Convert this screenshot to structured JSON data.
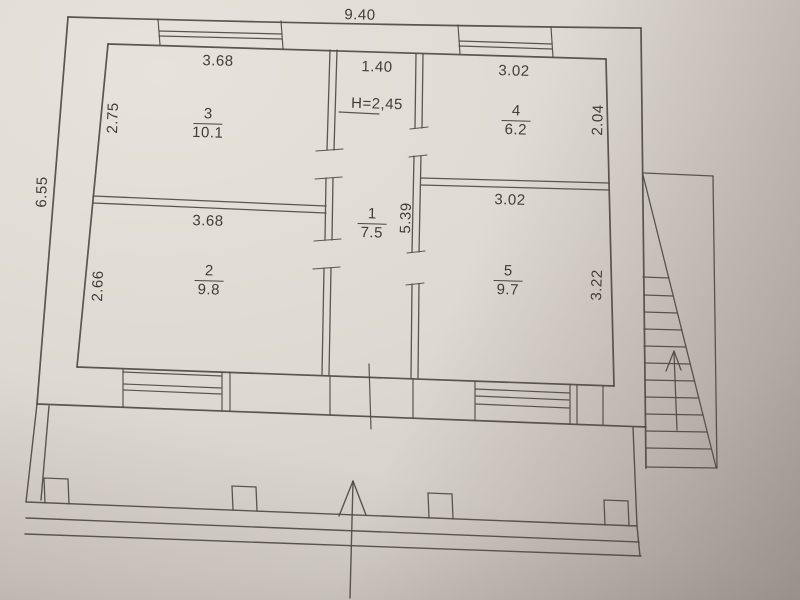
{
  "plan": {
    "overall": {
      "width": "9.40",
      "height": "6.55"
    },
    "ceiling_height": "H=2,45",
    "rooms": [
      {
        "number": "1",
        "area": "7.5",
        "width": "1.40",
        "height": "5.39"
      },
      {
        "number": "2",
        "area": "9.8",
        "width": "3.68",
        "height": "2.66"
      },
      {
        "number": "3",
        "area": "10.1",
        "width": "3.68",
        "height": "2.75"
      },
      {
        "number": "4",
        "area": "6.2",
        "width": "3.02",
        "height": "2.04"
      },
      {
        "number": "5",
        "area": "9.7",
        "width": "3.02",
        "height": "3.22"
      }
    ]
  }
}
